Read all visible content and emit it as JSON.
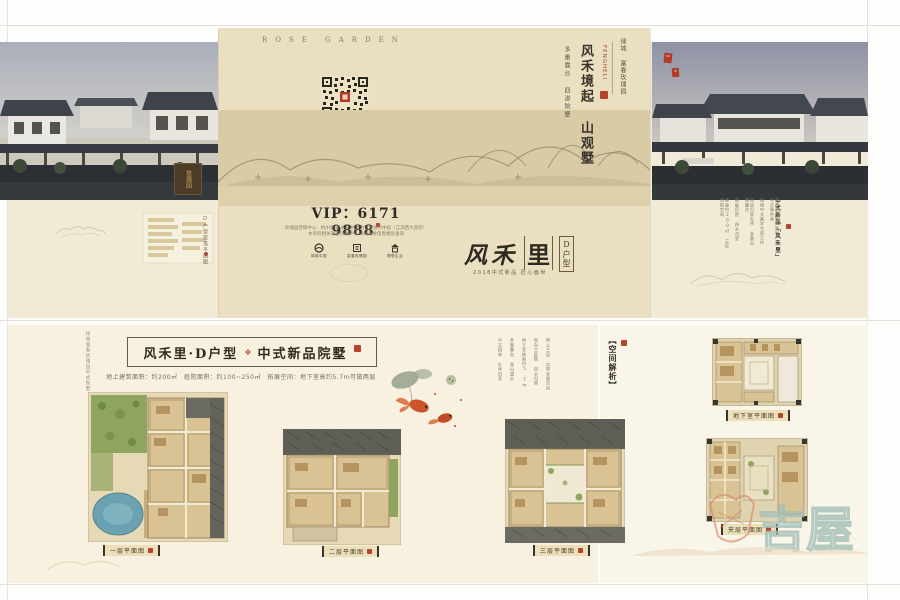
{
  "brand": {
    "rose_garden": "ROSE GARDEN",
    "name_cn": "绿城·富春玫瑰园",
    "logo_pinyin": "FENGHELI"
  },
  "cover": {
    "headline": "风禾境起 山观墅",
    "subline": "多重露台 四进院墅",
    "vip": "VIP：6171 9888",
    "address1": "玫瑰园营销中心：杭州富阳·东洲·杭富沿江发展带中段（江滨西大道旁）",
    "address2": "本资料相关内容仅供参考 详情请致电售楼处垂询",
    "logos": [
      "绿城中国",
      "富春玫瑰园",
      "理想生活"
    ],
    "calligraphy_a": "风禾",
    "calligraphy_b": "里",
    "tag": "D户型",
    "release": "2018中式新品 匠心面世"
  },
  "left_flap": {
    "plaque": "玫瑰园",
    "map_caption": "D户型院落平面图"
  },
  "right_flap": {
    "caption": "中式新品「风禾里」",
    "desc": [
      "富春山居图实景地 千年文脉传承",
      "绿城中式美学大成之作",
      "四进归家礼序 多重山景露台",
      "前庭后院 四水归堂",
      "建面约200㎡ 三层合院空间"
    ]
  },
  "detail": {
    "side_caption": "绿城富春玫瑰园中式院墅",
    "title_main": "风禾里·D户型",
    "title_sub": "中式新品院墅",
    "stats": "地上建筑面积：约200㎡　庭院面积：约100~250㎡　拓展空间：地下室高约5.7m可做两层",
    "analysis_title": "【空间解析】",
    "analysis": [
      "地上三层 实得多重空间",
      "南向主庭院 四水归堂",
      "地下室挑高约5.7m",
      "多重露台 观山望水",
      "中式园林 礼序归家"
    ],
    "plan_captions": [
      "一层平面图",
      "二层平面图",
      "三层平面图",
      "地下室平面图",
      "夹层平面图"
    ]
  },
  "watermark": "吉屋",
  "colors": {
    "accent_red": "#b5432f",
    "cream": "#eadfc1",
    "teal": "#a3c0b8"
  }
}
